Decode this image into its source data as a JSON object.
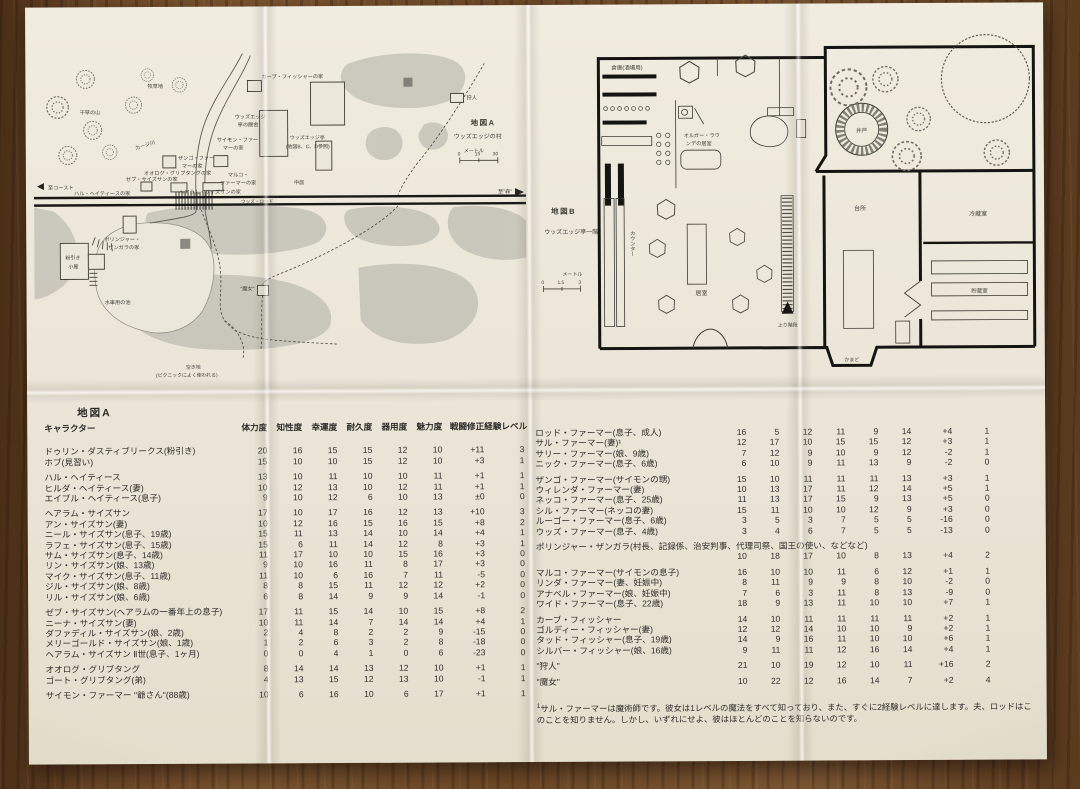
{
  "map_a": {
    "title": "地図A",
    "subtitle": "ウッズエッジの村",
    "scale_unit": "メートル",
    "scale_ticks": [
      "0",
      "15",
      "30"
    ],
    "labels": {
      "pasture": "牧草地",
      "haystack": "干草の山",
      "river": "カージ川",
      "to_coast": "至コースト",
      "to_forest": "至\"森\"",
      "woods_road": "ウッズ・ロード",
      "house_fisher": "カーブ・フィッシャーの家",
      "inn_stable": [
        "ウッズエッジ",
        "亭の厩舎"
      ],
      "inn": [
        "ウッズエッジ亭",
        "(地図B、C、D参照)"
      ],
      "courtyard": "中庭",
      "house_simon": [
        "サイモン・ファー",
        "マーの家"
      ],
      "house_zango": [
        "ザンゴ・ファー",
        "マーの家"
      ],
      "house_ohlog": "オオログ・グリブタングの家",
      "house_marco": [
        "マルコ・",
        "ファーマーの家"
      ],
      "house_zeb": "ゼブ・サイズサンの家",
      "house_hal": "ハル・ヘイティースの家",
      "house_hairam": "ヘアラム・サイズサンの家",
      "hunter": "狩人",
      "house_bolinger": [
        "ポリンジャー・",
        "ザンガラの家"
      ],
      "mill": [
        "粉引き",
        "小屋"
      ],
      "pond": "水車用の池",
      "clearing": [
        "空き地",
        "(ピクニックによく使われる)"
      ],
      "witch": "\"魔女\""
    }
  },
  "map_b": {
    "title": "地図B",
    "subtitle": "ウッズエッジ亭一階",
    "scale_unit": "メートル",
    "scale_ticks": [
      "0",
      "1.5",
      "3"
    ],
    "labels": {
      "storage": "倉庫(酒場用)",
      "olgar_room": [
        "オルガー・ラウ",
        "ンデの居室"
      ],
      "counter": "カウンター",
      "living_room": "居室",
      "stairs_up": "上り階段",
      "well": "井戸",
      "kitchen": "台所",
      "cold_room": "冷蔵室",
      "pantry": "貯蔵室",
      "hearth": "かまど"
    }
  },
  "table": {
    "section": "地図A",
    "header": {
      "name": "キャラクター",
      "cols": [
        "体力度",
        "知性度",
        "幸運度",
        "耐久度",
        "器用度",
        "魅力度",
        "戦闘修正",
        "経験レベル"
      ]
    },
    "left_groups": [
      [
        [
          "ドゥリン・ダスティブリークス(粉引き)",
          "20",
          "16",
          "15",
          "15",
          "12",
          "10",
          "+11",
          "3"
        ],
        [
          "ホブ(見習い)",
          "15",
          "10",
          "10",
          "15",
          "12",
          "10",
          "+3",
          "1"
        ]
      ],
      [
        [
          "ハル・ヘイティース",
          "13",
          "10",
          "11",
          "10",
          "10",
          "11",
          "+1",
          "1"
        ],
        [
          "ヒルダ・ヘイティース(妻)",
          "10",
          "12",
          "13",
          "10",
          "12",
          "11",
          "+1",
          "1"
        ],
        [
          "エイブル・ヘイティース(息子)",
          "9",
          "10",
          "12",
          "6",
          "10",
          "13",
          "±0",
          "0"
        ]
      ],
      [
        [
          "ヘアラム・サイズサン",
          "17",
          "10",
          "17",
          "16",
          "12",
          "13",
          "+10",
          "3"
        ],
        [
          "アン・サイズサン(妻)",
          "10",
          "12",
          "16",
          "15",
          "16",
          "15",
          "+8",
          "2"
        ],
        [
          "ニール・サイズサン(息子、19歳)",
          "15",
          "11",
          "13",
          "14",
          "10",
          "14",
          "+4",
          "1"
        ],
        [
          "ラフェ・サイズサン(息子、15歳)",
          "15",
          "6",
          "11",
          "14",
          "12",
          "8",
          "+3",
          "1"
        ],
        [
          "サム・サイズサン(息子、14歳)",
          "11",
          "17",
          "10",
          "10",
          "15",
          "16",
          "+3",
          "0"
        ],
        [
          "リン・サイズサン(娘、13歳)",
          "9",
          "10",
          "16",
          "11",
          "8",
          "17",
          "+3",
          "0"
        ],
        [
          "マイク・サイズサン(息子、11歳)",
          "11",
          "10",
          "6",
          "16",
          "7",
          "11",
          "-5",
          "0"
        ],
        [
          "ジル・サイズサン(娘、8歳)",
          "8",
          "8",
          "15",
          "11",
          "12",
          "12",
          "+2",
          "0"
        ],
        [
          "リル・サイズサン(娘、6歳)",
          "6",
          "8",
          "14",
          "9",
          "9",
          "14",
          "-1",
          "0"
        ]
      ],
      [
        [
          "ゼブ・サイズサン(ヘアラムの一番年上の息子)",
          "17",
          "11",
          "15",
          "14",
          "10",
          "15",
          "+8",
          "2"
        ],
        [
          "ニーナ・サイズサン(妻)",
          "10",
          "11",
          "14",
          "7",
          "14",
          "14",
          "+4",
          "1"
        ],
        [
          "ダファディル・サイズサン(娘、2歳)",
          "2",
          "4",
          "8",
          "2",
          "2",
          "9",
          "-15",
          "0"
        ],
        [
          "メリーゴールド・サイズサン(娘、1歳)",
          "1",
          "2",
          "6",
          "3",
          "2",
          "8",
          "-18",
          "0"
        ],
        [
          "ヘアラム・サイズサン Ⅱ世(息子、1ヶ月)",
          "0",
          "0",
          "4",
          "1",
          "0",
          "6",
          "-23",
          "0"
        ]
      ],
      [
        [
          "オオログ・グリブタング",
          "8",
          "14",
          "14",
          "13",
          "12",
          "10",
          "+1",
          "1"
        ],
        [
          "ゴート・グリブタング(弟)",
          "4",
          "13",
          "15",
          "12",
          "13",
          "10",
          "-1",
          "1"
        ]
      ],
      [
        [
          "サイモン・ファーマー \"爺さん\"(88歳)",
          "10",
          "6",
          "16",
          "10",
          "6",
          "17",
          "+1",
          "1"
        ]
      ]
    ],
    "right_groups": [
      [
        [
          "ロッド・ファーマー(息子、成人)",
          "16",
          "5",
          "12",
          "11",
          "9",
          "14",
          "+4",
          "1"
        ],
        [
          "サル・ファーマー(妻)¹",
          "12",
          "17",
          "10",
          "15",
          "15",
          "12",
          "+3",
          "1"
        ],
        [
          "サリー・ファーマー(娘、9歳)",
          "7",
          "12",
          "9",
          "10",
          "9",
          "12",
          "-2",
          "1"
        ],
        [
          "ニック・ファーマー(息子、6歳)",
          "6",
          "10",
          "9",
          "11",
          "13",
          "9",
          "-2",
          "0"
        ]
      ],
      [
        [
          "ザンゴ・ファーマー(サイモンの甥)",
          "15",
          "10",
          "11",
          "11",
          "11",
          "13",
          "+3",
          "1"
        ],
        [
          "ウィレンダ・ファーマー(妻)",
          "10",
          "13",
          "17",
          "11",
          "12",
          "14",
          "+5",
          "1"
        ],
        [
          "ネッコ・ファーマー(息子、25歳)",
          "11",
          "13",
          "17",
          "15",
          "9",
          "13",
          "+5",
          "0"
        ],
        [
          "シル・ファーマー(ネッコの妻)",
          "15",
          "11",
          "10",
          "10",
          "12",
          "9",
          "+3",
          "0"
        ],
        [
          "ルーゴー・ファーマー(息子、6歳)",
          "3",
          "5",
          "3",
          "7",
          "5",
          "5",
          "-16",
          "0"
        ],
        [
          "ウッズ・ファーマー(息子、4歳)",
          "3",
          "4",
          "6",
          "7",
          "5",
          "5",
          "-13",
          "0"
        ]
      ],
      [
        {
          "wide": true,
          "r": [
            "ポリンジャー・ザンガラ(村長、記録係、治安判事、代理司祭、国王の使い、などなど)",
            "10",
            "18",
            "17",
            "10",
            "8",
            "13",
            "+4",
            "2"
          ]
        }
      ],
      [
        [
          "マルコ・ファーマー(サイモンの息子)",
          "16",
          "10",
          "10",
          "11",
          "6",
          "12",
          "+1",
          "1"
        ],
        [
          "リンダ・ファーマー(妻、妊娠中)",
          "8",
          "11",
          "9",
          "9",
          "8",
          "10",
          "-2",
          "0"
        ],
        [
          "アナベル・ファーマー(娘、妊娠中)",
          "7",
          "6",
          "3",
          "11",
          "8",
          "13",
          "-9",
          "0"
        ],
        [
          "ワイド・ファーマー(息子、22歳)",
          "18",
          "9",
          "13",
          "11",
          "10",
          "10",
          "+7",
          "1"
        ]
      ],
      [
        [
          "カーブ・フィッシャー",
          "14",
          "10",
          "11",
          "11",
          "11",
          "11",
          "+2",
          "1"
        ],
        [
          "ゴルディー・フィッシャー(妻)",
          "12",
          "12",
          "14",
          "10",
          "10",
          "9",
          "+2",
          "1"
        ],
        [
          "タッド・フィッシャー(息子、19歳)",
          "14",
          "9",
          "16",
          "11",
          "10",
          "10",
          "+6",
          "1"
        ],
        [
          "シルバー・フィッシャー(娘、16歳)",
          "9",
          "11",
          "11",
          "12",
          "16",
          "14",
          "+4",
          "1"
        ]
      ],
      [
        [
          "\"狩人\"",
          "21",
          "10",
          "19",
          "12",
          "10",
          "11",
          "+16",
          "2"
        ]
      ],
      [
        [
          "\"魔女\"",
          "10",
          "22",
          "12",
          "16",
          "14",
          "7",
          "+2",
          "4"
        ]
      ]
    ],
    "footnote_sup": "1",
    "footnote": "サル・ファーマーは魔術師です。彼女は1レベルの魔法をすべて知っており、また、すぐに2経験レベルに達します。夫、ロッドはこのことを知りません。しかし、いずれにせよ、彼はほとんどのことを知らないのです。"
  }
}
